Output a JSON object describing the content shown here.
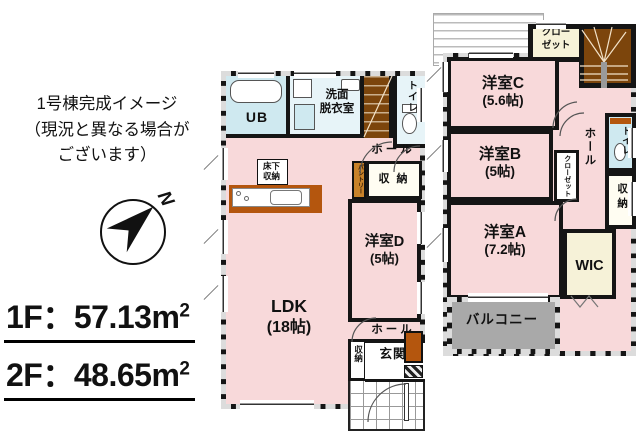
{
  "annotation": {
    "line1": "1号棟完成イメージ",
    "line2": "（現況と異なる場合が",
    "line3": "ございます）"
  },
  "compass": {
    "north_label": "N"
  },
  "areas": {
    "floor1": {
      "label": "1F",
      "colon": "：",
      "value": "57.13",
      "unit": "m",
      "unit_sup": "2"
    },
    "floor2": {
      "label": "2F",
      "colon": "：",
      "value": "48.65",
      "unit": "m",
      "unit_sup": "2"
    }
  },
  "floor1": {
    "rooms": {
      "ub": "UB",
      "washroom_line1": "洗面",
      "washroom_line2": "脱衣室",
      "toilet": "トイレ",
      "hall_upper": "ホール",
      "underfloor_line1": "床下",
      "underfloor_line2": "収納",
      "pantry": "パントリー",
      "storage_upper": "収 納",
      "room_d_name": "洋室D",
      "room_d_size": "(5帖)",
      "ldk_name": "LDK",
      "ldk_size": "(18帖)",
      "hall_lower": "ホール",
      "storage_lower": "収納",
      "entrance": "玄関"
    }
  },
  "floor2": {
    "rooms": {
      "closet_line1": "クロー",
      "closet_line2": "ゼット",
      "room_c_name": "洋室C",
      "room_c_size": "(5.6帖)",
      "room_b_name": "洋室B",
      "room_b_size": "(5帖)",
      "room_a_name": "洋室A",
      "room_a_size": "(7.2帖)",
      "closet_small": "クローゼット",
      "hall": "ホール",
      "toilet": "トイレ",
      "storage": "収納",
      "wic": "WIC",
      "balcony": "バルコニー"
    }
  },
  "colors": {
    "room_pink": "#f8d9da",
    "wet_blue": "#cfe9f0",
    "wet_blue_light": "#e7f4f8",
    "closet_cream": "#f6f2d8",
    "balcony_gray": "#a9a9a9",
    "stair_brown": "#7c450c",
    "cabinet_brown": "#b4560e",
    "pantry_orange": "#c8822a",
    "wall_black": "#151515"
  }
}
